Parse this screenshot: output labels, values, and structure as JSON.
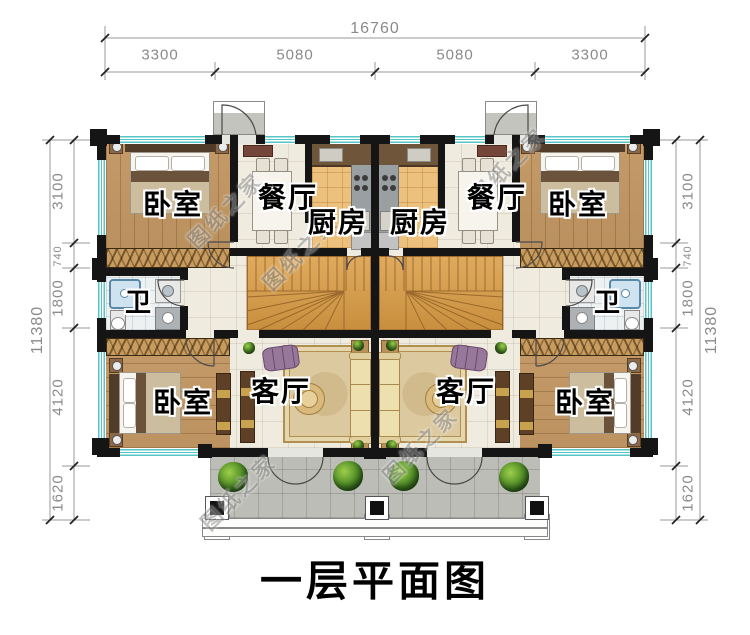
{
  "title": "一层平面图",
  "watermark": "图纸之家",
  "dims": {
    "top_total": "16760",
    "top_segs": [
      "3300",
      "5080",
      "5080",
      "3300"
    ],
    "side_total": "11380",
    "side_segs": [
      "3100",
      "740",
      "1800",
      "4120",
      "1620"
    ]
  },
  "rooms": {
    "bedroom": "卧室",
    "dining": "餐厅",
    "kitchen": "厨房",
    "bath": "卫",
    "living": "客厅"
  },
  "colors": {
    "wall": "#151515",
    "window_teal": "#57c5c7",
    "wood_floor": "#c09a66",
    "kitchen_tile": "#ecc17e",
    "stair_wood": "#d3a050",
    "porch_gray": "#bcbdb6",
    "dim_text": "#8a8a8a"
  }
}
